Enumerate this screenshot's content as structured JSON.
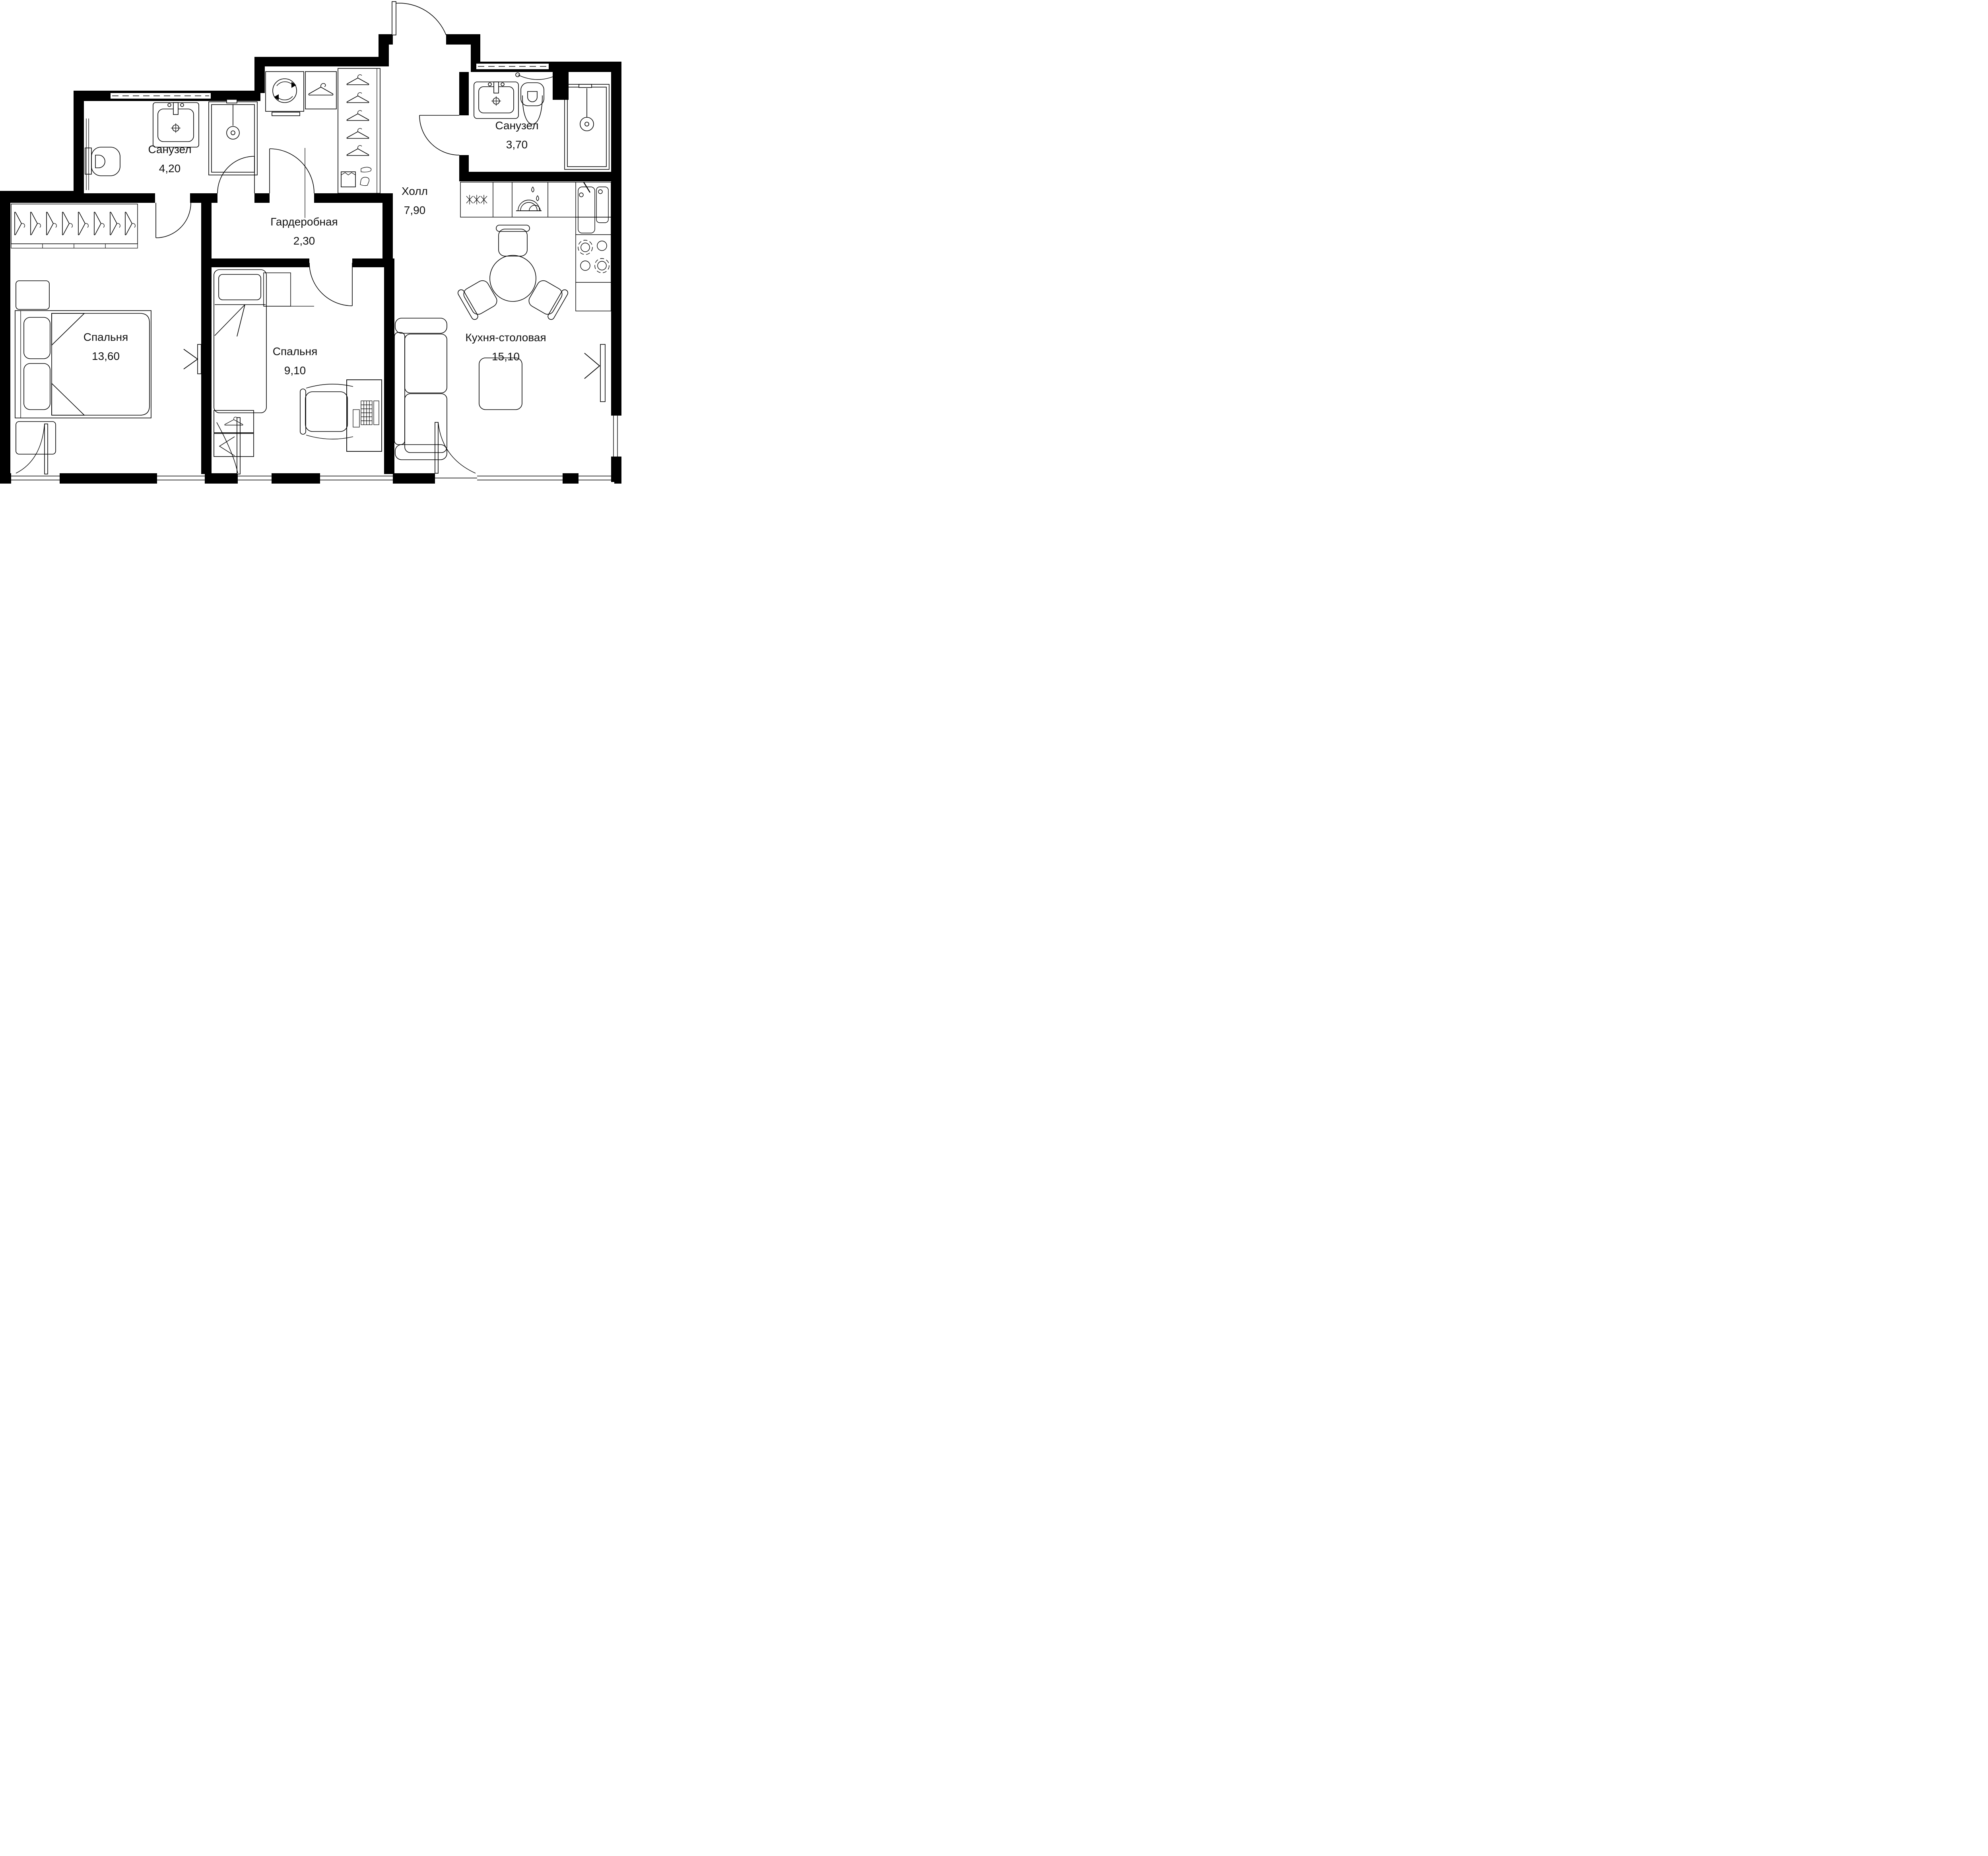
{
  "plan": {
    "title": "Apartment floor plan",
    "background_color": "#ffffff",
    "wall_color": "#000000",
    "rooms": [
      {
        "key": "bathroom-1",
        "name": "Санузел",
        "area": "4,20"
      },
      {
        "key": "bathroom-2",
        "name": "Санузел",
        "area": "3,70"
      },
      {
        "key": "wardrobe",
        "name": "Гардеробная",
        "area": "2,30"
      },
      {
        "key": "hall",
        "name": "Холл",
        "area": "7,90"
      },
      {
        "key": "bedroom-1",
        "name": "Спальня",
        "area": "13,60"
      },
      {
        "key": "bedroom-2",
        "name": "Спальня",
        "area": "9,10"
      },
      {
        "key": "kitchen-dining",
        "name": "Кухня-столовая",
        "area": "15,10"
      }
    ],
    "furniture_symbols": [
      "toilet",
      "vanity-sink",
      "shower-cabin",
      "towel-rail",
      "washing-machine",
      "coat-hanger",
      "wardrobe-cabinet",
      "shoes",
      "box",
      "double-bed",
      "single-bed",
      "pillow",
      "nightstand",
      "tv-panel",
      "desk",
      "office-chair",
      "laptop",
      "sofa",
      "dining-table",
      "chair",
      "rug",
      "fridge-freezer",
      "dishwasher",
      "kitchen-sink",
      "stove",
      "door-swing",
      "window"
    ]
  }
}
